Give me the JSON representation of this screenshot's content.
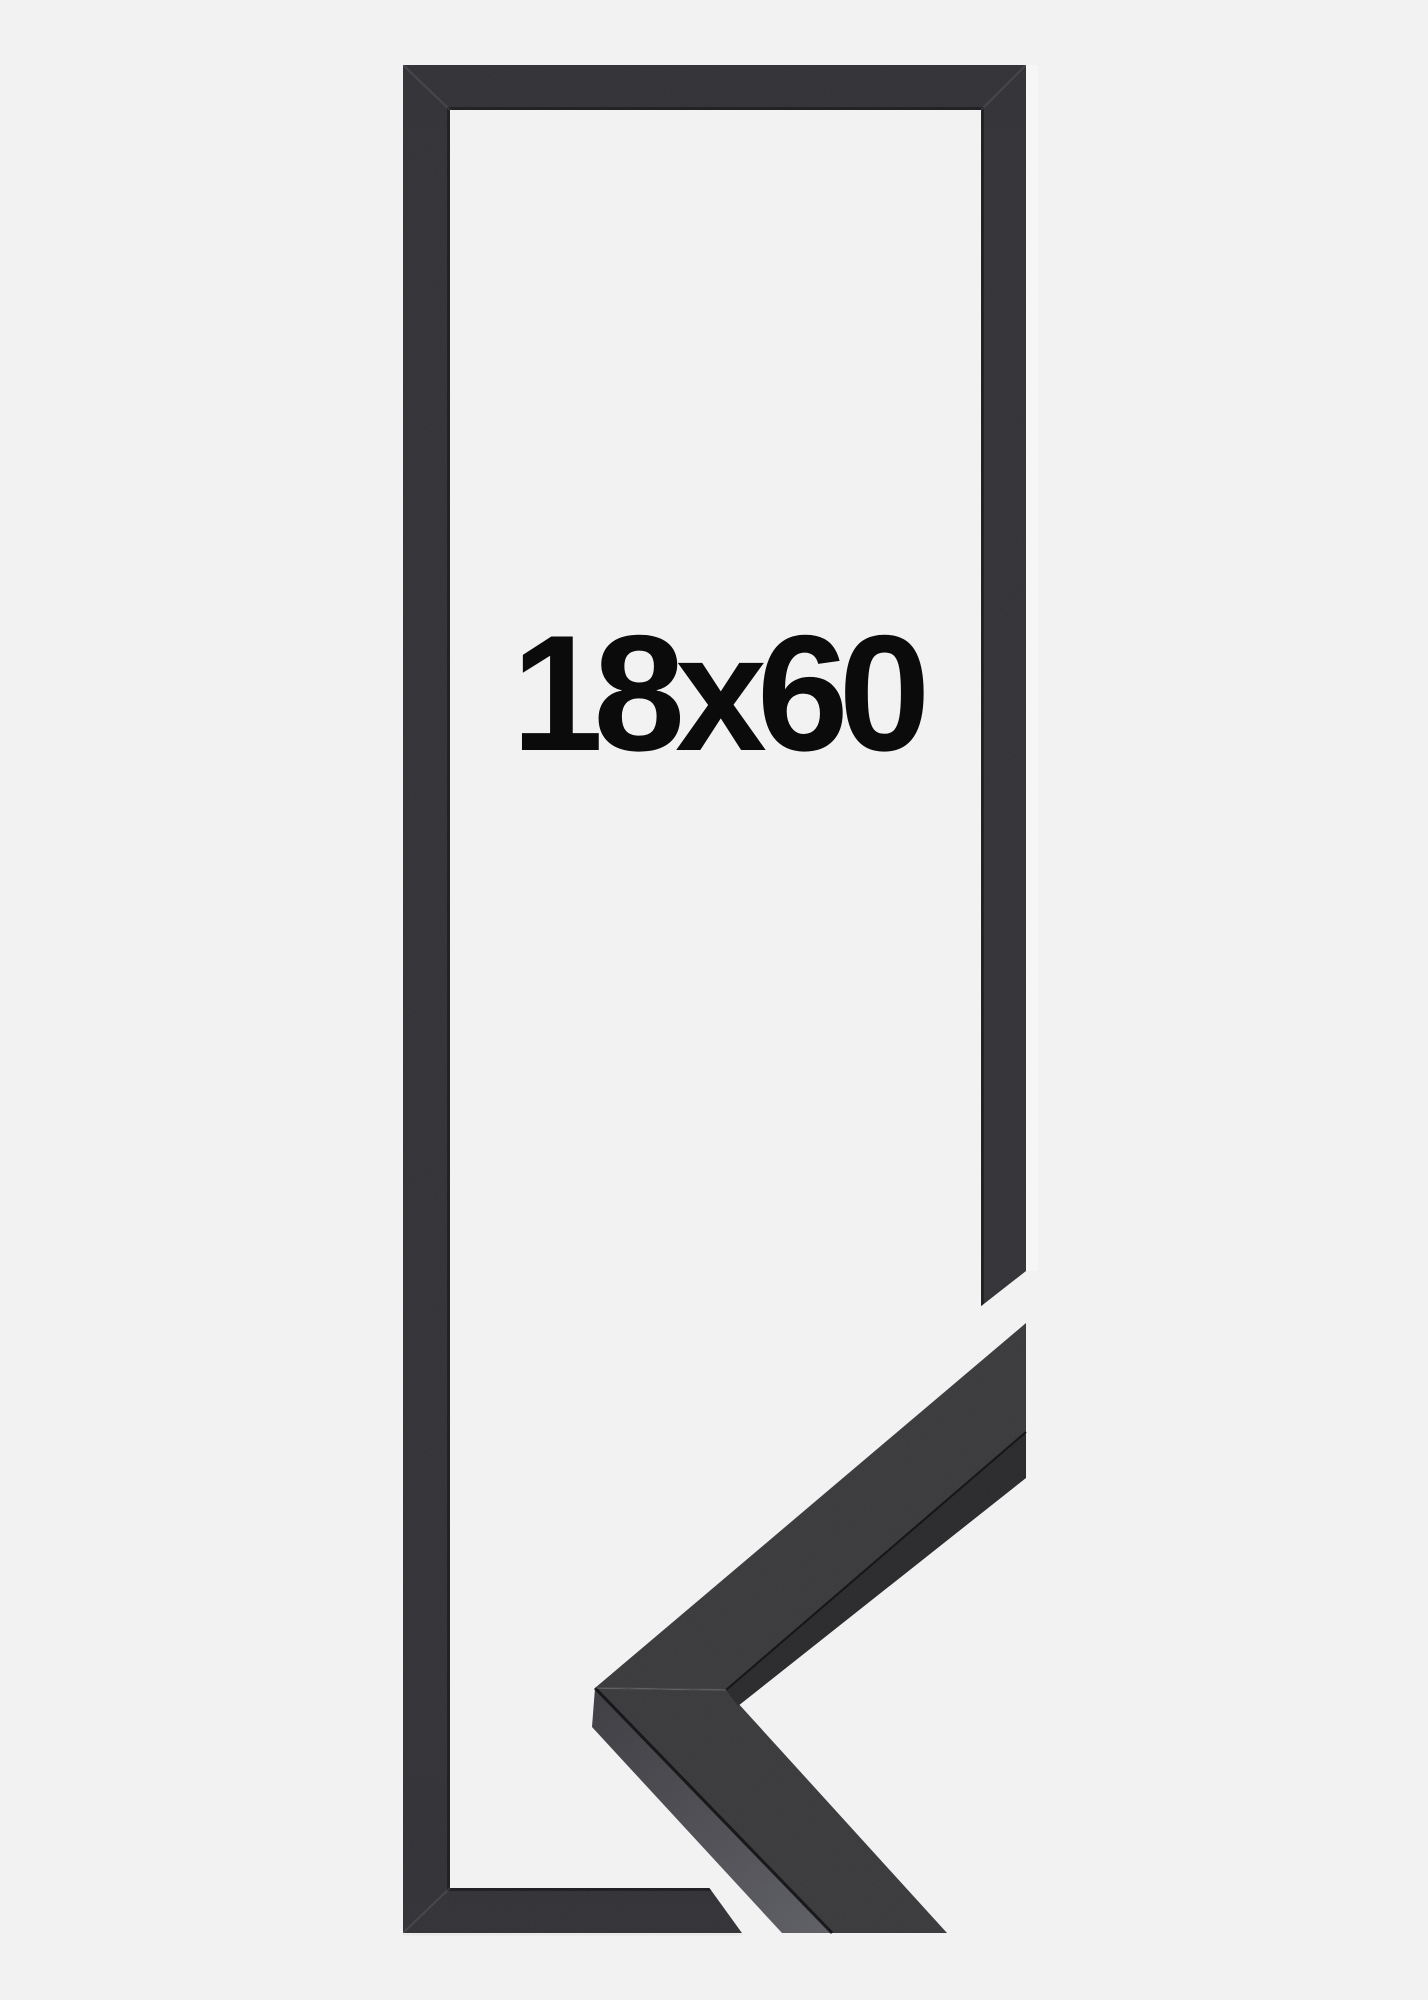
{
  "product_image": {
    "size_label": "18x60",
    "colors": {
      "background": "#f2f2f3",
      "label": "#0b0b0b",
      "frame": "#333236",
      "frame_inner_rim": "rgba(12,12,14,0.5)",
      "miter_seam_light": "rgba(255,255,255,0.09)",
      "sample_face": "#3a3a3d",
      "sample_side_from": "#3e3e43",
      "sample_side_to": "#5e5e65",
      "sample_inner_edge": "#2a2a2d",
      "crease": "rgba(10,10,12,0.85)",
      "photo_edge": "rgba(0,0,0,0.05)",
      "photo_glow": "rgba(255,255,255,0.35)"
    }
  }
}
